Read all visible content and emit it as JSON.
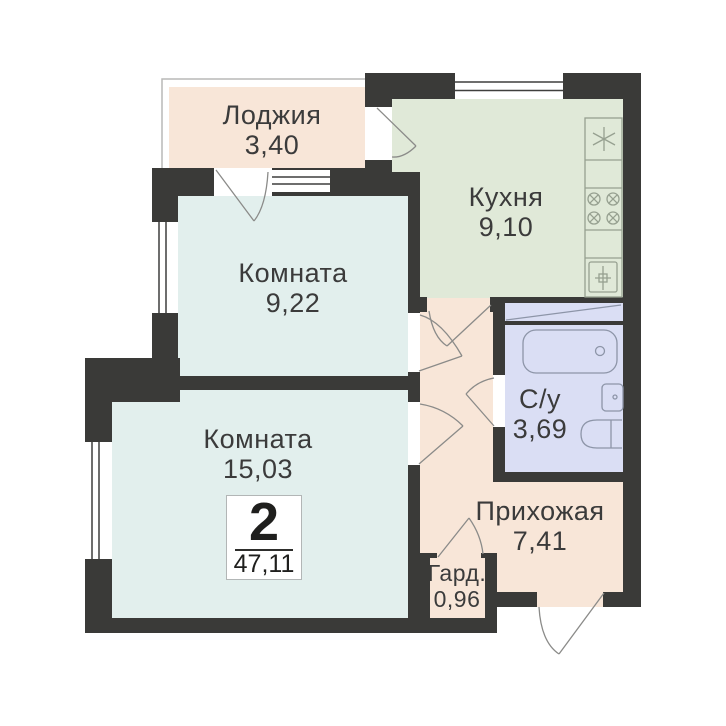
{
  "plan": {
    "badge": {
      "rooms_count": "2",
      "total_area": "47,11"
    },
    "rooms": [
      {
        "name": "Лоджия",
        "area": "3,40"
      },
      {
        "name": "Кухня",
        "area": "9,10"
      },
      {
        "name": "Комната",
        "area": "9,22"
      },
      {
        "name": "Комната",
        "area": "15,03"
      },
      {
        "name": "С/у",
        "area": "3,69"
      },
      {
        "name": "Прихожая",
        "area": "7,41"
      },
      {
        "name": "Гард.",
        "area": "0,96"
      }
    ],
    "colors": {
      "wall": "#3a3a38",
      "loggia": "#f8e6d8",
      "kitchen": "#e0e9d8",
      "living": "#e2efed",
      "bathroom": "#dadef4",
      "hallway": "#f8e6d8",
      "parapet": "#b9b9b7",
      "window_line": "#3f3f3d",
      "door_arc": "#8b8b89",
      "kitchen_fixture": "#96a090",
      "bath_fixture": "#8d95a8",
      "text": "#3b3b3b"
    }
  }
}
